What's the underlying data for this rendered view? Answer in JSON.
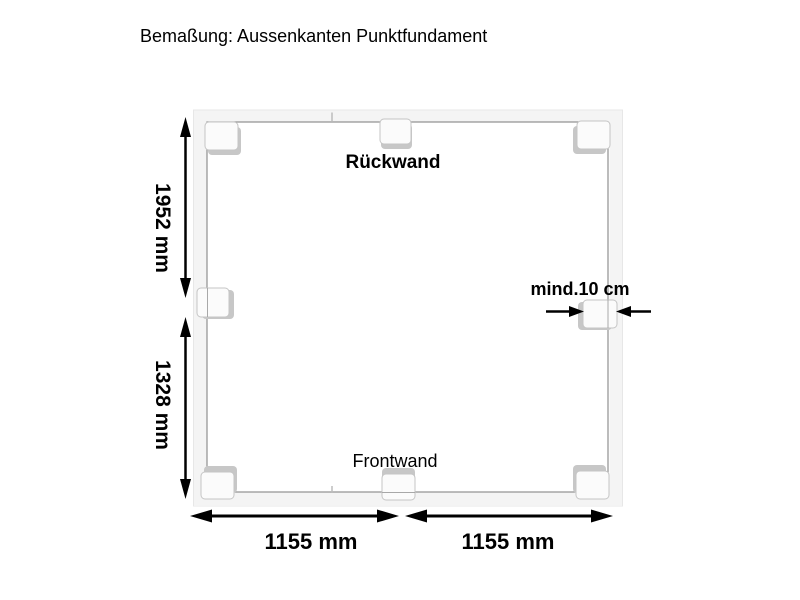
{
  "title": "Bemaßung: Aussenkanten Punktfundament",
  "diagram": {
    "labels": {
      "back_wall": "Rückwand",
      "front_wall": "Frontwand",
      "min_distance": "mind.10 cm"
    },
    "dimensions": {
      "left_upper": "1952 mm",
      "left_lower": "1328 mm",
      "bottom_left": "1155 mm",
      "bottom_right": "1155 mm"
    },
    "foundation_blocks_count": 8,
    "colors": {
      "background": "#ffffff",
      "dimension_ink": "#000000",
      "frame_line": "#8f8f8f",
      "block_face": "#fbfbfb",
      "block_side": "#c7c7c7"
    }
  }
}
